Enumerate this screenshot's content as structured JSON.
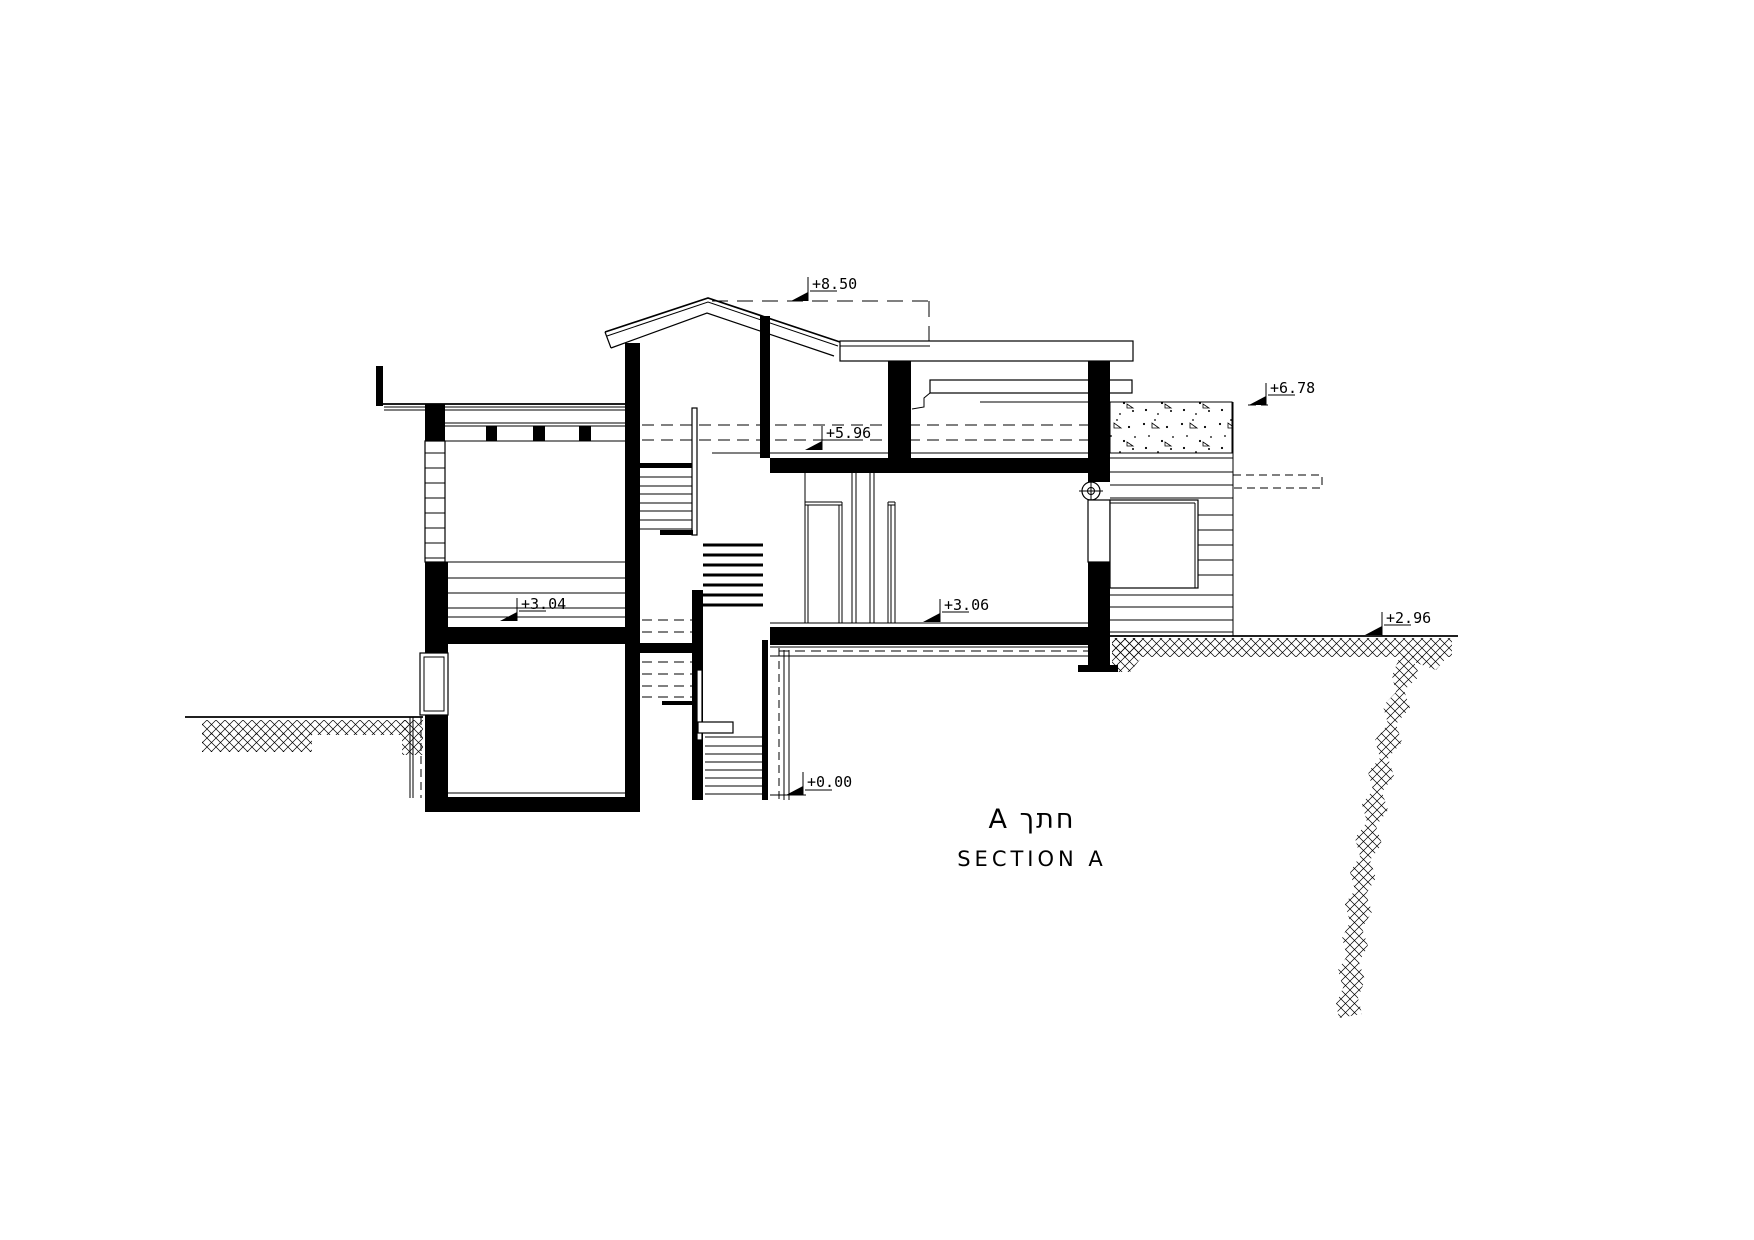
{
  "document": {
    "type": "architectural-section-drawing",
    "paper_color": "#ffffff",
    "ink_color": "#000000"
  },
  "title": {
    "primary": "A חתך",
    "secondary": "SECTION A"
  },
  "levels": {
    "roof_ridge": {
      "label": "+8.50"
    },
    "annex_roof": {
      "label": "+6.78"
    },
    "upper_floor": {
      "label": "+5.96"
    },
    "left_room_floor": {
      "label": "+3.04"
    },
    "main_floor": {
      "label": "+3.06"
    },
    "grade_right": {
      "label": "+2.96"
    },
    "basement_floor": {
      "label": "+0.00"
    }
  }
}
